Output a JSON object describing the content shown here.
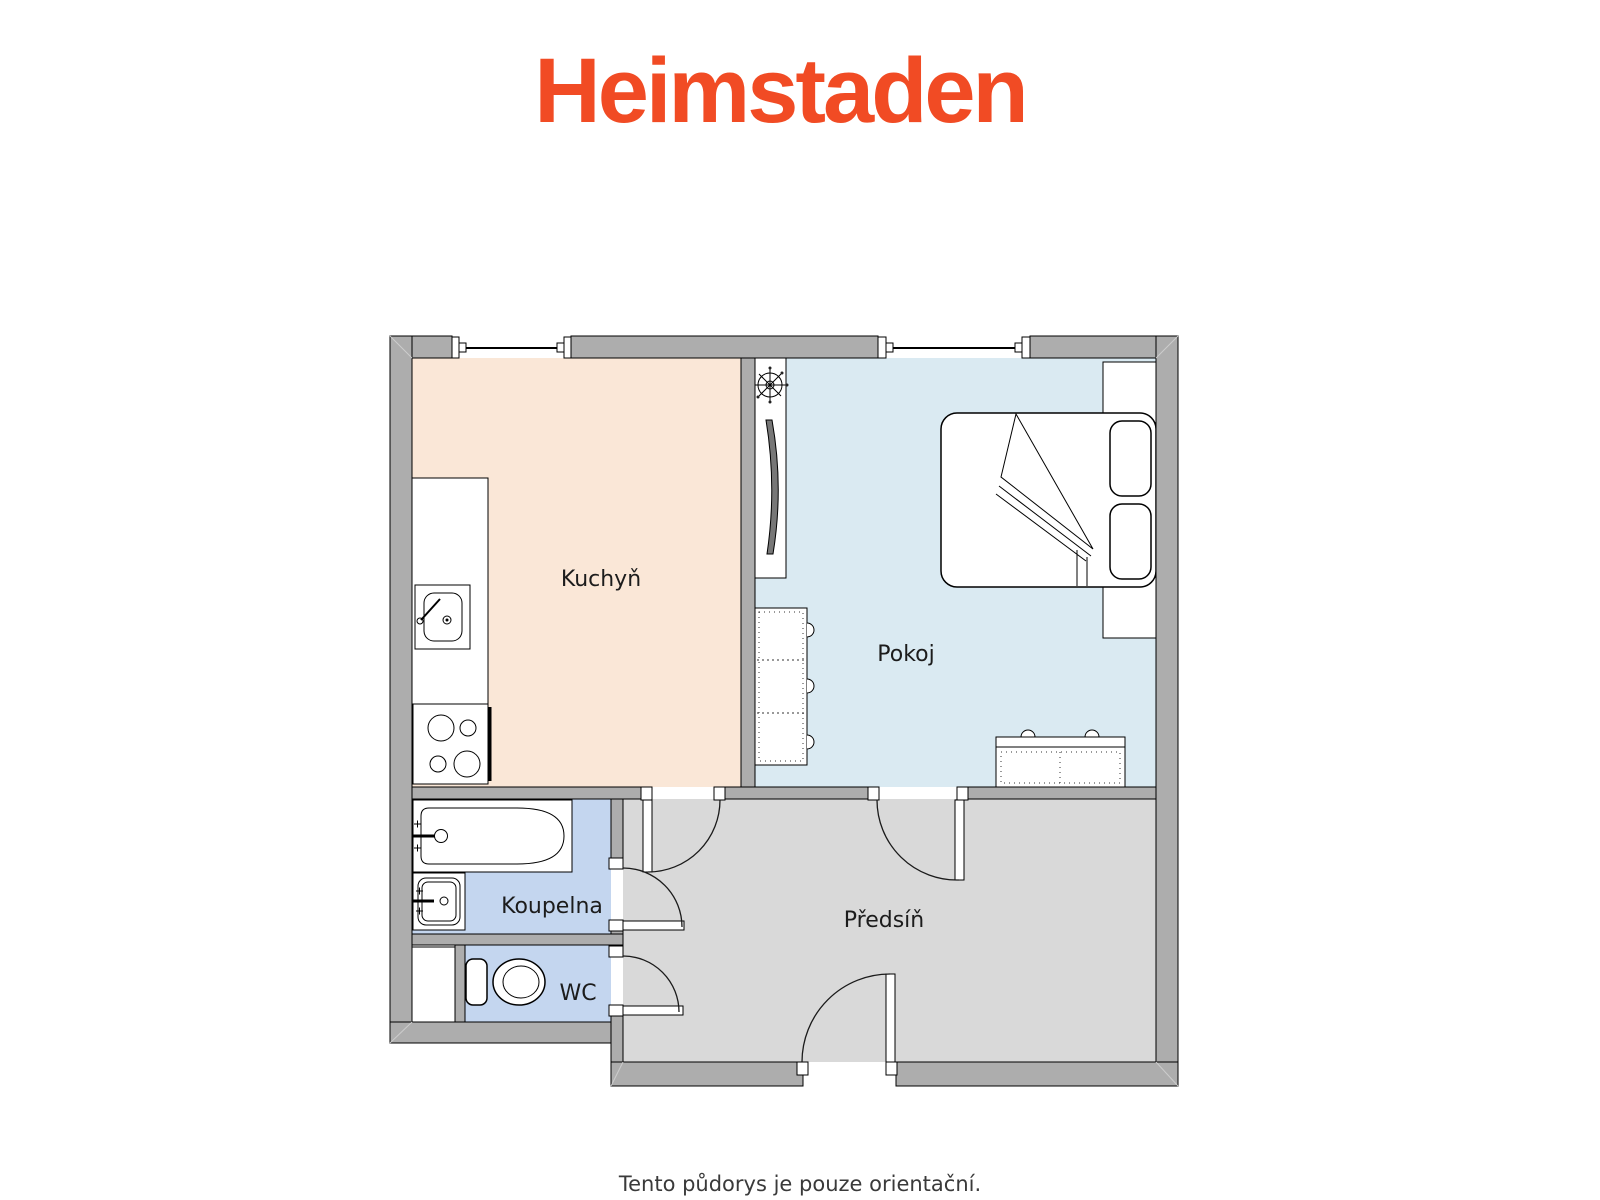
{
  "brand": {
    "logo_text": "Heimstaden",
    "logo_color": "#F14B24"
  },
  "plan": {
    "rooms": [
      {
        "id": "kuchyn",
        "label": "Kuchyň",
        "floor_color": "#FAE7D7"
      },
      {
        "id": "pokoj",
        "label": "Pokoj",
        "floor_color": "#DAEAF2"
      },
      {
        "id": "koupelna",
        "label": "Koupelna",
        "floor_color": "#C4D6EF"
      },
      {
        "id": "wc",
        "label": "WC",
        "floor_color": "#C4D6EF"
      },
      {
        "id": "predsin",
        "label": "Předsíň",
        "floor_color": "#D9D9D9"
      }
    ],
    "palette": {
      "wall": "#ADADAD",
      "tv_screen": "#777777",
      "outline": "#000000"
    }
  },
  "footer": {
    "note": "Tento půdorys je pouze orientační."
  }
}
